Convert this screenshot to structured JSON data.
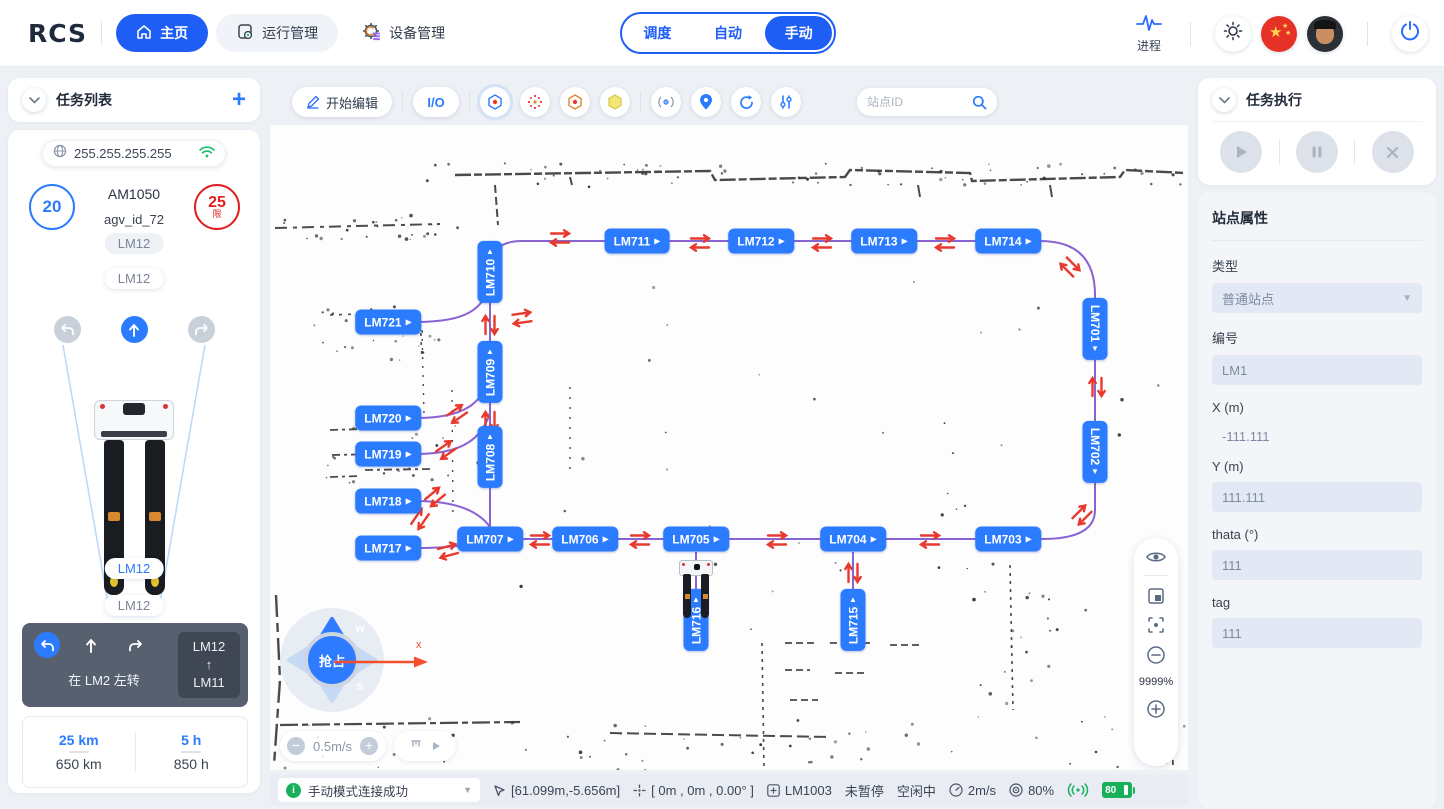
{
  "nav": {
    "logo": "RCS",
    "home": "主页",
    "ops": "运行管理",
    "devices": "设备管理",
    "modes": [
      "调度",
      "自动",
      "手动"
    ],
    "process": "进程"
  },
  "left": {
    "task_list_title": "任务列表",
    "ip": "255.255.255.255",
    "speed": "20",
    "limit": "25",
    "limit_tag": "限",
    "model": "AM1050",
    "agv_id": "agv_id_72",
    "badge1": "LM12",
    "badge2": "LM12",
    "badge3": "LM12",
    "badge4": "LM12",
    "nav_text": "在 LM2 左转",
    "nav_from": "LM12",
    "nav_arrow": "↑",
    "nav_to": "LM11",
    "trip_km": "25 km",
    "total_km": "650 km",
    "trip_h": "5 h",
    "total_h": "850 h"
  },
  "map": {
    "edit": "开始编辑",
    "io": "I/O",
    "search_placeholder": "站点ID",
    "grab": "抢占",
    "keys": [
      "W",
      "A",
      "S",
      "D"
    ],
    "speed_step": "0.5m/s",
    "axis": "x",
    "zoom": "9999%",
    "stations": [
      {
        "id": "LM711",
        "x": 367,
        "y": 116,
        "o": "h"
      },
      {
        "id": "LM712",
        "x": 491,
        "y": 116,
        "o": "h"
      },
      {
        "id": "LM713",
        "x": 614,
        "y": 116,
        "o": "h"
      },
      {
        "id": "LM714",
        "x": 738,
        "y": 116,
        "o": "h"
      },
      {
        "id": "LM710",
        "x": 220,
        "y": 147,
        "o": "vu"
      },
      {
        "id": "LM721",
        "x": 118,
        "y": 197,
        "o": "h"
      },
      {
        "id": "LM709",
        "x": 220,
        "y": 247,
        "o": "vu"
      },
      {
        "id": "LM720",
        "x": 118,
        "y": 293,
        "o": "h"
      },
      {
        "id": "LM719",
        "x": 118,
        "y": 329,
        "o": "h"
      },
      {
        "id": "LM708",
        "x": 220,
        "y": 332,
        "o": "vu"
      },
      {
        "id": "LM718",
        "x": 118,
        "y": 376,
        "o": "h"
      },
      {
        "id": "LM717",
        "x": 118,
        "y": 423,
        "o": "h"
      },
      {
        "id": "LM707",
        "x": 220,
        "y": 414,
        "o": "h"
      },
      {
        "id": "LM706",
        "x": 315,
        "y": 414,
        "o": "h"
      },
      {
        "id": "LM705",
        "x": 426,
        "y": 414,
        "o": "h"
      },
      {
        "id": "LM704",
        "x": 583,
        "y": 414,
        "o": "h"
      },
      {
        "id": "LM703",
        "x": 738,
        "y": 414,
        "o": "h"
      },
      {
        "id": "LM701",
        "x": 825,
        "y": 204,
        "o": "vd"
      },
      {
        "id": "LM702",
        "x": 825,
        "y": 327,
        "o": "vd"
      },
      {
        "id": "LM716",
        "x": 426,
        "y": 495,
        "o": "vu"
      },
      {
        "id": "LM715",
        "x": 583,
        "y": 495,
        "o": "vu"
      }
    ],
    "arrows": [
      {
        "x": 290,
        "y": 113,
        "a": 0
      },
      {
        "x": 430,
        "y": 118,
        "a": 0
      },
      {
        "x": 552,
        "y": 118,
        "a": 0
      },
      {
        "x": 675,
        "y": 118,
        "a": 0
      },
      {
        "x": 800,
        "y": 142,
        "a": 45
      },
      {
        "x": 827,
        "y": 262,
        "a": 90
      },
      {
        "x": 812,
        "y": 390,
        "a": 135
      },
      {
        "x": 660,
        "y": 415,
        "a": 0
      },
      {
        "x": 507,
        "y": 415,
        "a": 0
      },
      {
        "x": 370,
        "y": 415,
        "a": 0
      },
      {
        "x": 270,
        "y": 415,
        "a": 0
      },
      {
        "x": 583,
        "y": 448,
        "a": 90
      },
      {
        "x": 220,
        "y": 200,
        "a": 90
      },
      {
        "x": 220,
        "y": 296,
        "a": 90
      },
      {
        "x": 252,
        "y": 193,
        "a": -8
      },
      {
        "x": 187,
        "y": 289,
        "a": -35
      },
      {
        "x": 176,
        "y": 325,
        "a": -35
      },
      {
        "x": 165,
        "y": 372,
        "a": -40
      },
      {
        "x": 150,
        "y": 394,
        "a": -55
      },
      {
        "x": 178,
        "y": 426,
        "a": -15
      }
    ]
  },
  "right": {
    "exec_title": "任务执行",
    "props_title": "站点属性",
    "f_type_label": "类型",
    "f_type_value": "普通站点",
    "f_code_label": "编号",
    "f_code_value": "LM1",
    "f_x_label": "X (m)",
    "f_x_value": "-111.111",
    "f_y_label": "Y (m)",
    "f_y_value": "111.111",
    "f_theta_label": "thata (°)",
    "f_theta_value": "111",
    "f_tag_label": "tag",
    "f_tag_value": "111"
  },
  "status": {
    "message": "手动模式连接成功",
    "position": "[61.099m,-5.656m]",
    "pose": "[ 0m , 0m , 0.00° ]",
    "station": "LM1003",
    "pause": "未暂停",
    "idle": "空闲中",
    "speed": "2m/s",
    "load": "80%",
    "battery": "80"
  }
}
